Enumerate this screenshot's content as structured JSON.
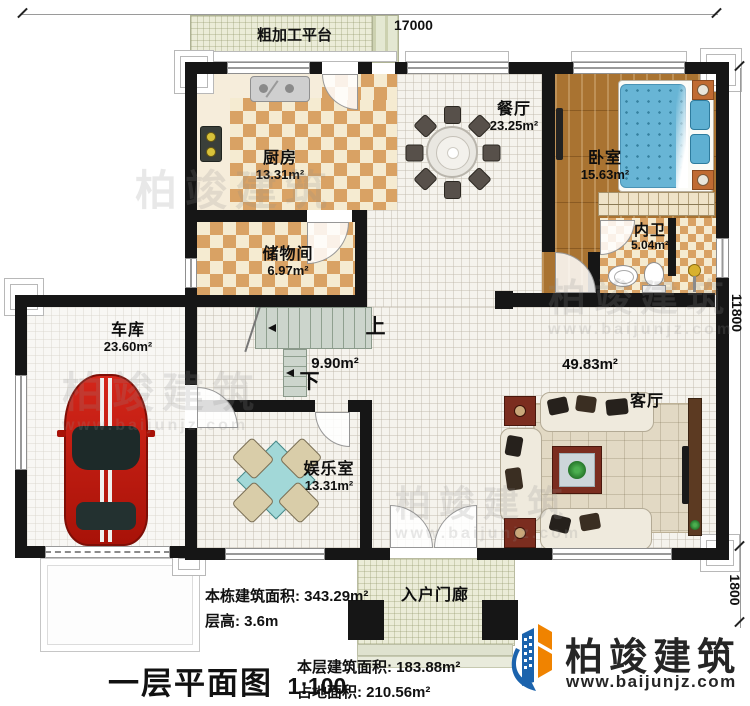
{
  "dimensions": {
    "top": "17000",
    "side_main": "11800",
    "side_porch": "1800"
  },
  "rooms": {
    "platform": {
      "label": "粗加工平台"
    },
    "kitchen": {
      "label": "厨房",
      "area": "13.31m²"
    },
    "dining": {
      "label": "餐厅",
      "area": "23.25m²"
    },
    "bedroom": {
      "label": "卧室",
      "area": "15.63m²"
    },
    "bathroom": {
      "label": "内卫",
      "area": "5.04m²"
    },
    "storage": {
      "label": "储物间",
      "area": "6.97m²"
    },
    "garage": {
      "label": "车库",
      "area": "23.60m²"
    },
    "entertainment": {
      "label": "娱乐室",
      "area": "13.31m²"
    },
    "living": {
      "label": "客厅",
      "area": "49.83m²"
    },
    "stairs": {
      "up": "上",
      "down": "下",
      "area": "9.90m²"
    },
    "porch": {
      "label": "入户门廊"
    }
  },
  "notes": {
    "building_total": "本栋建筑面积: 343.29m²",
    "floor_height": "层高: 3.6m",
    "floor_area": "本层建筑面积: 183.88m²",
    "footprint": "占地面积: 210.56m²"
  },
  "title": {
    "text": "一层平面图",
    "scale": "1:100"
  },
  "brand": {
    "name": "柏竣建筑",
    "url": "www.baijunjz.com"
  },
  "watermark": {
    "name": "柏竣建筑",
    "url": "www.baijunjz.com"
  },
  "colors": {
    "wall": "#161616",
    "checker": "#d9a264",
    "wood": "#a97331",
    "bed": "#68b5d5",
    "brand_blue": "#1b63ad",
    "brand_orange": "#f08300"
  }
}
